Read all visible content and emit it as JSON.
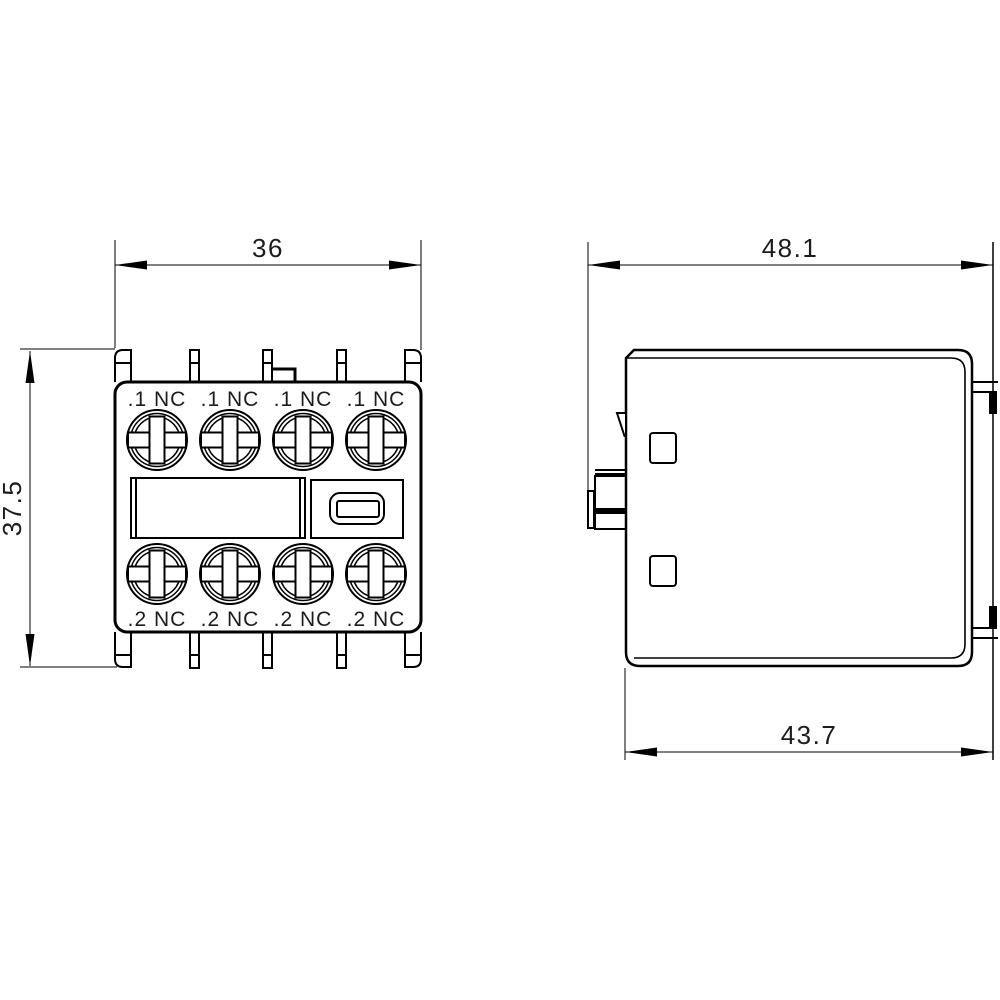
{
  "drawing": {
    "title": "auxiliary-switch-block-dimension-drawing",
    "front_view": {
      "top_terminal_labels": [
        ".1 NC",
        ".1 NC",
        ".1 NC",
        ".1 NC"
      ],
      "bottom_terminal_labels": [
        ".2 NC",
        ".2 NC",
        ".2 NC",
        ".2 NC"
      ],
      "width_dimension": "36",
      "height_dimension": "37.5"
    },
    "side_view": {
      "top_width_dimension": "48.1",
      "bottom_width_dimension": "43.7"
    },
    "colors": {
      "line": "#000000",
      "background": "#ffffff",
      "text": "#1c1c1c"
    }
  }
}
